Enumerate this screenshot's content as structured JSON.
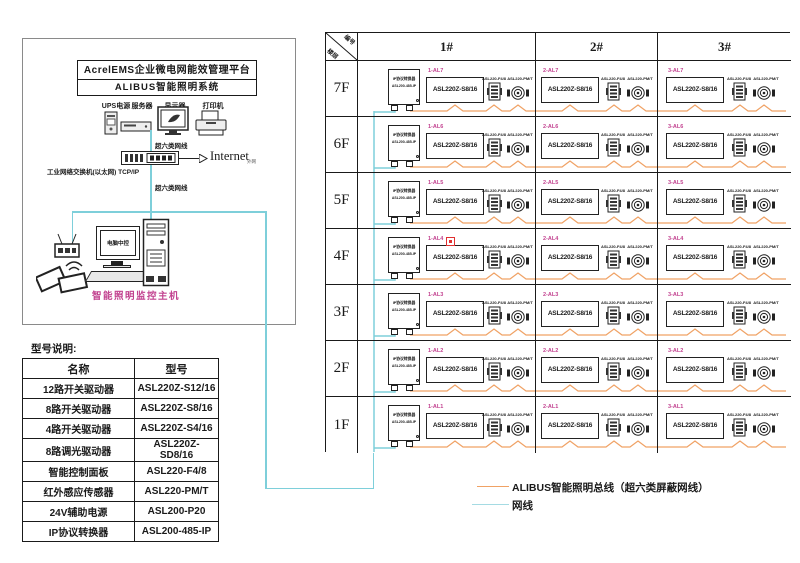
{
  "platform": {
    "title_line1": "AcrelEMS企业微电网能效管理平台",
    "title_line2": "ALIBUS智能照明系统",
    "device_labels": [
      "UPS电源",
      "服务器",
      "显示器",
      "打印机"
    ],
    "cable_top": "超六类网线",
    "cable_bottom": "超六类网线",
    "switch_label": "工业网络交换机(以太网) TCP/IP",
    "internet": "Internet",
    "internet_note": "外网",
    "host_screen": "电脑中控",
    "host_label": "智能照明监控主机"
  },
  "model_table": {
    "title": "型号说明:",
    "headers": [
      "名称",
      "型号"
    ],
    "rows": [
      [
        "12路开关驱动器",
        "ASL220Z-S12/16"
      ],
      [
        "8路开关驱动器",
        "ASL220Z-S8/16"
      ],
      [
        "4路开关驱动器",
        "ASL220Z-S4/16"
      ],
      [
        "8路调光驱动器",
        "ASL220Z-SD8/16"
      ],
      [
        "智能控制面板",
        "ASL220-F4/8"
      ],
      [
        "红外感应传感器",
        "ASL220-PM/T"
      ],
      [
        "24V辅助电源",
        "ASL200-P20"
      ],
      [
        "IP协议转换器",
        "ASL200-485-IP"
      ]
    ]
  },
  "grid": {
    "corner": {
      "top_right": "编号",
      "bottom_left": "楼层"
    },
    "columns": [
      "1#",
      "2#",
      "3#"
    ],
    "floors": [
      "7F",
      "6F",
      "5F",
      "4F",
      "3F",
      "2F",
      "1F"
    ],
    "ip_converter": {
      "name": "IP协议转换器",
      "model": "ASL200-485-IP"
    },
    "driver_model": "ASL220Z-S8/16",
    "panel_model": "ASL220-F4/8",
    "sensor_model": "ASL220-PM/T",
    "rows": [
      {
        "floor": "7F",
        "labels": [
          "1-AL7",
          "2-AL7",
          "3-AL7"
        ]
      },
      {
        "floor": "6F",
        "labels": [
          "1-AL6",
          "2-AL6",
          "3-AL6"
        ]
      },
      {
        "floor": "5F",
        "labels": [
          "1-AL5",
          "2-AL5",
          "3-AL5"
        ]
      },
      {
        "floor": "4F",
        "labels": [
          "1-AL4",
          "2-AL4",
          "3-AL4"
        ]
      },
      {
        "floor": "3F",
        "labels": [
          "1-AL3",
          "2-AL3",
          "3-AL3"
        ]
      },
      {
        "floor": "2F",
        "labels": [
          "1-AL2",
          "2-AL2",
          "3-AL2"
        ]
      },
      {
        "floor": "1F",
        "labels": [
          "1-AL1",
          "2-AL1",
          "3-AL1"
        ]
      }
    ]
  },
  "legend": {
    "bus_label": "ALIBUS智能照明总线（超六类屏蔽网线）",
    "net_label": "网线"
  },
  "colors": {
    "bus_line": "#F0A265",
    "net_line": "#7ECFDA",
    "legend_net_line": "#A5DBE3",
    "circuit_label": "#C2418F",
    "marker_red": "#E03030"
  }
}
